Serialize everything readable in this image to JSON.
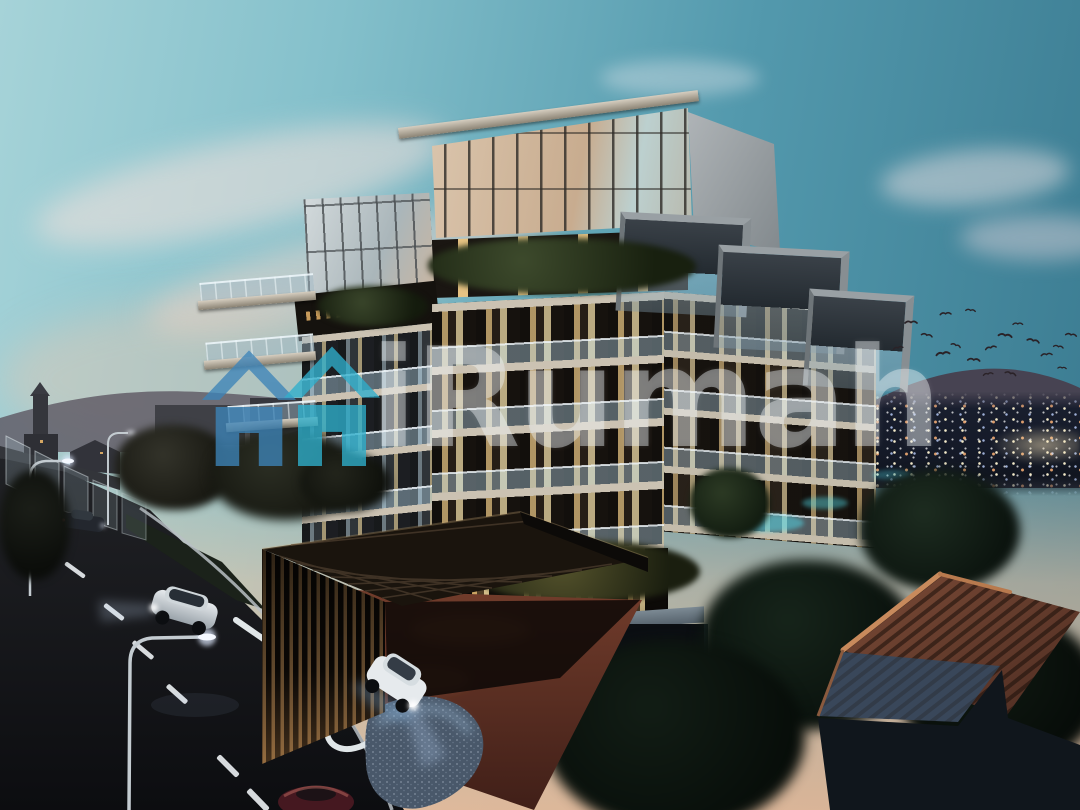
{
  "image": {
    "kind": "architectural-rendering",
    "subject": "modern terraced low-rise condominium at dusk with entrance driveway",
    "width_px": 1080,
    "height_px": 810
  },
  "watermark": {
    "text": "iRumah",
    "text_color": "#EEF3F6",
    "text_opacity": 0.42,
    "logo": {
      "left_house_color": "#3D84B8",
      "right_house_color": "#2FB0CD",
      "opacity": 0.78
    }
  },
  "palette": {
    "sky_top_left": "#A6D3D8",
    "sky_top_right": "#39798F",
    "sky_horizon": "#F3BC96",
    "cloud_pink": "#F5DDD2",
    "building_slab": "#CBC2B2",
    "building_facade_dark": "#221E1A",
    "window_warm": "#E5C282",
    "window_bright": "#F2DDA8",
    "balustrade_glass": "#96AFBE",
    "road": "#101114",
    "lane_marking": "#E8ECEF",
    "curb": "#DDE3E6",
    "driveway": "#713C2B",
    "canopy_slat": "#7F5F3A",
    "mountain_far": "#474352",
    "mountain_near": "#2C2F3C",
    "city_light_warm": "#FFD27A",
    "tile_roof": "#7A4A36",
    "tile_roof_shadow": "#39475A",
    "tree_dark": "#0D1410",
    "pool_glow": "#35CFE0"
  },
  "scene": {
    "birds": [
      [
        905,
        320,
        1,
        0
      ],
      [
        922,
        332,
        0.9,
        12
      ],
      [
        936,
        352,
        1.1,
        -8
      ],
      [
        952,
        342,
        0.8,
        20
      ],
      [
        968,
        357,
        1.0,
        5
      ],
      [
        985,
        347,
        0.9,
        -14
      ],
      [
        999,
        332,
        1.1,
        8
      ],
      [
        1013,
        322,
        0.8,
        0
      ],
      [
        1028,
        337,
        1.0,
        14
      ],
      [
        1041,
        353,
        0.9,
        -6
      ],
      [
        1054,
        344,
        0.8,
        10
      ],
      [
        1006,
        370,
        0.9,
        16
      ],
      [
        983,
        373,
        0.8,
        -10
      ],
      [
        966,
        308,
        0.8,
        6
      ],
      [
        940,
        312,
        0.9,
        -4
      ],
      [
        1066,
        332,
        0.9,
        8
      ],
      [
        893,
        347,
        0.8,
        -12
      ],
      [
        1058,
        366,
        0.7,
        4
      ]
    ],
    "vehicles": [
      {
        "name": "sedan-distant-road",
        "color": "#23272E",
        "headlights": "on"
      },
      {
        "name": "suv-main-road",
        "color": "#DFE3E6",
        "headlights": "on"
      },
      {
        "name": "car-entrance-driveway",
        "color": "#E8ECEF",
        "headlights": "on"
      },
      {
        "name": "car-bottom-edge",
        "color": "#46161C",
        "headlights": "off"
      }
    ],
    "street_lamp_count": 3,
    "lane_dash_count": 8
  }
}
